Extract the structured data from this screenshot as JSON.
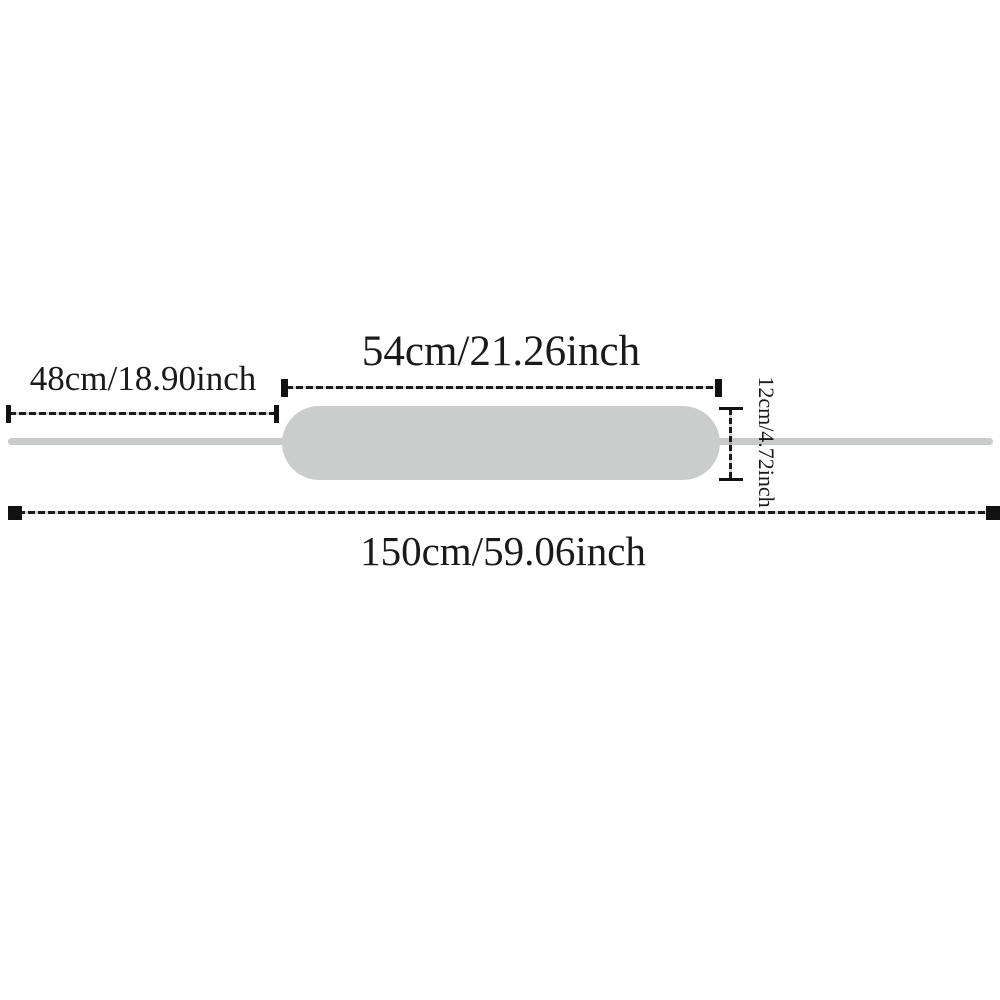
{
  "diagram": {
    "kind": "product-dimension-diagram",
    "labels": {
      "left_strap": "48cm/18.90inch",
      "pad_width": "54cm/21.26inch",
      "pad_height": "12cm/4.72inch",
      "total_length": "150cm/59.06inch"
    },
    "measurements": [
      {
        "name": "left-strap-length",
        "cm": 48,
        "inch": 18.9,
        "label": "48cm/18.90inch"
      },
      {
        "name": "pad-width",
        "cm": 54,
        "inch": 21.26,
        "label": "54cm/21.26inch"
      },
      {
        "name": "pad-height",
        "cm": 12,
        "inch": 4.72,
        "label": "12cm/4.72inch"
      },
      {
        "name": "total-length",
        "cm": 150,
        "inch": 59.06,
        "label": "150cm/59.06inch"
      }
    ],
    "colors": {
      "ink": "#1a1a1a",
      "pad_fill": "#cbcdcd",
      "strap_line": "#c9caca",
      "background": "#ffffff"
    }
  }
}
